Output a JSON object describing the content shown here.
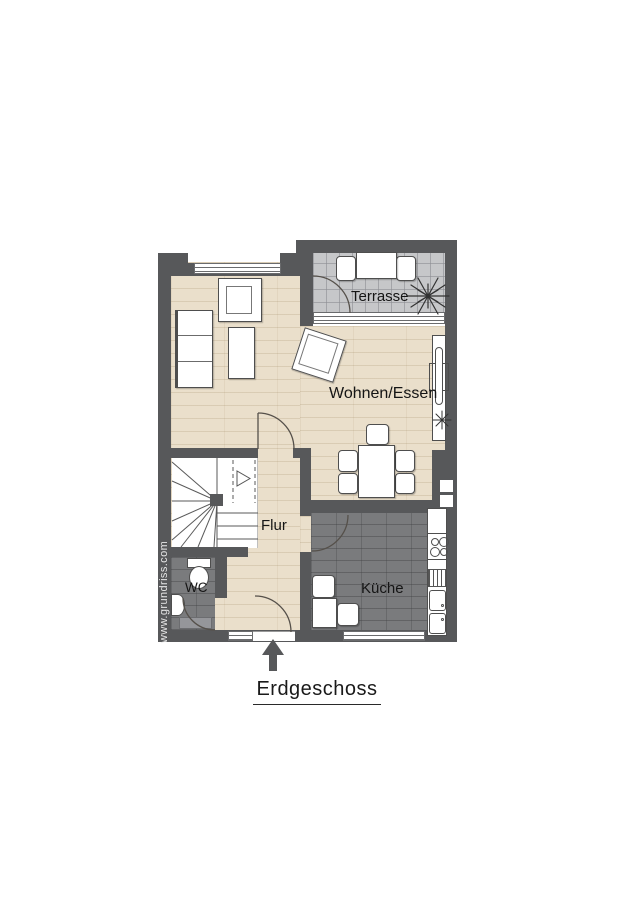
{
  "title": "Erdgeschoss",
  "watermark": "www.grundriss.com",
  "rooms": {
    "terrace": {
      "label": "Terrasse"
    },
    "living": {
      "label": "Wohnen/Essen"
    },
    "hall": {
      "label": "Flur"
    },
    "wc": {
      "label": "WC"
    },
    "kitchen": {
      "label": "Küche"
    }
  },
  "colors": {
    "wall": "#57585a",
    "wood": "#eadfcb",
    "terrace": "#c6c7c9",
    "darktile": "#7a7b7d",
    "label": "#151515"
  }
}
